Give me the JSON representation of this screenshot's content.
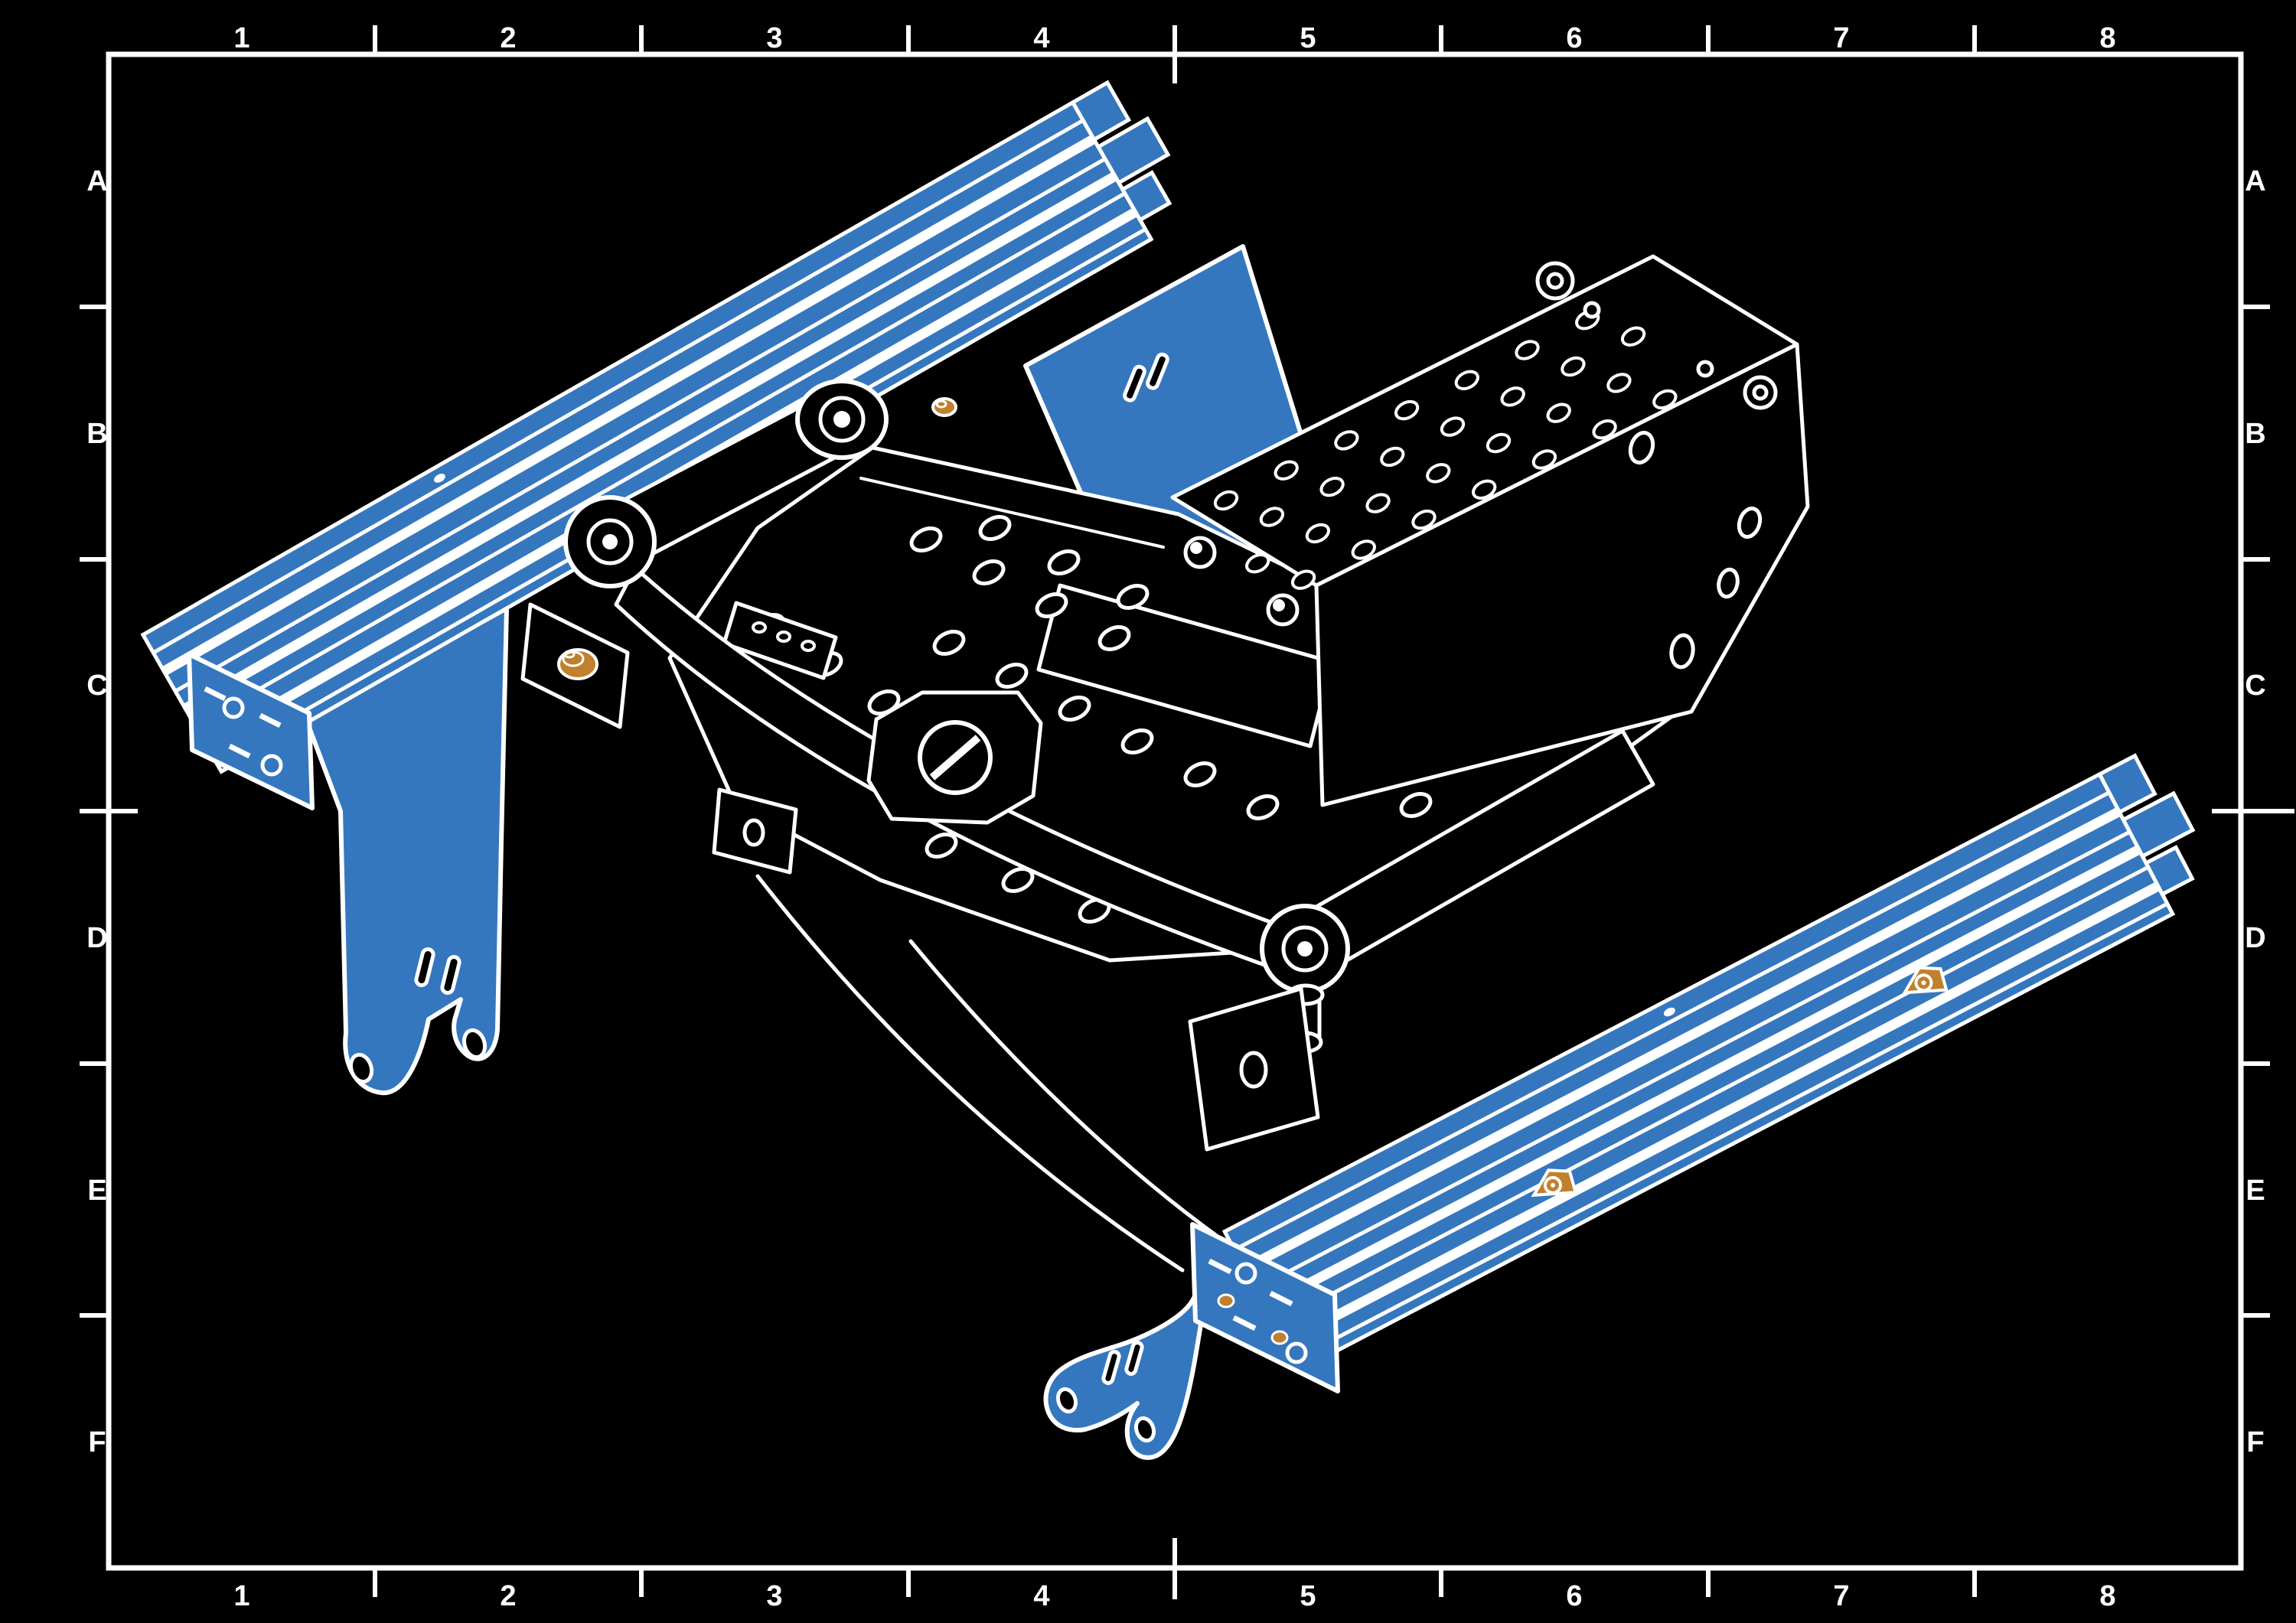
{
  "sheet": {
    "kind_label": "isometric exploded assembly drawing",
    "colors": {
      "background": "#000000",
      "line": "#ffffff",
      "highlight_blue": "#3577BE",
      "fastener_orange": "#C0802D"
    },
    "grid": {
      "columns": [
        "1",
        "2",
        "3",
        "4",
        "5",
        "6",
        "7",
        "8"
      ],
      "rows": [
        "A",
        "B",
        "C",
        "D",
        "E",
        "F"
      ]
    }
  }
}
